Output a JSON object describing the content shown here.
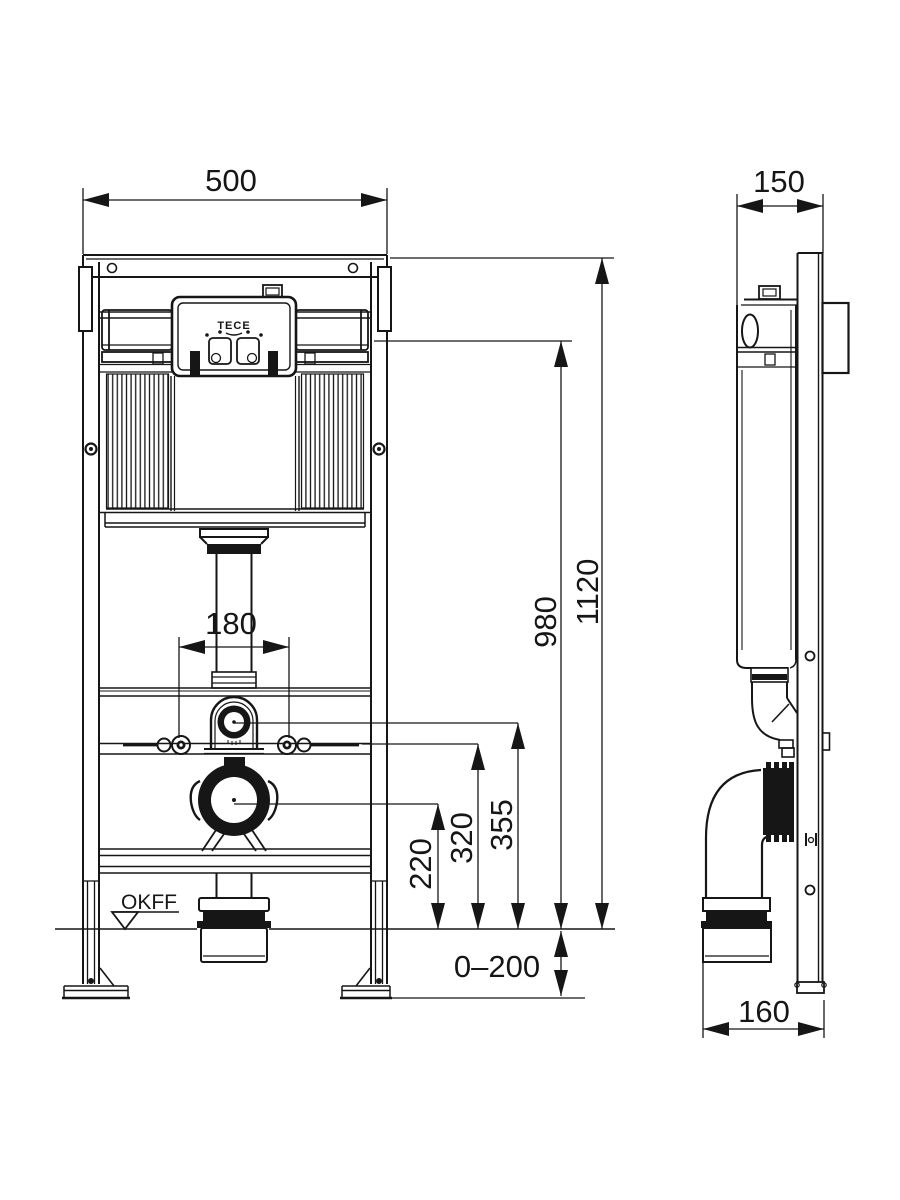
{
  "drawing": {
    "brand_label": "TECE",
    "floor_level_label": "OKFF",
    "front_view": {
      "frame_width": "500",
      "total_height": "1120",
      "panel_height": "980",
      "water_connection_height": "355",
      "fixing_height": "320",
      "drain_center_height": "220",
      "bolt_spacing": "180",
      "foot_adjustment_range": "0–200"
    },
    "side_view": {
      "frame_depth": "150",
      "drain_offset": "160"
    },
    "colors": {
      "line": "#161616",
      "background": "#ffffff"
    }
  }
}
